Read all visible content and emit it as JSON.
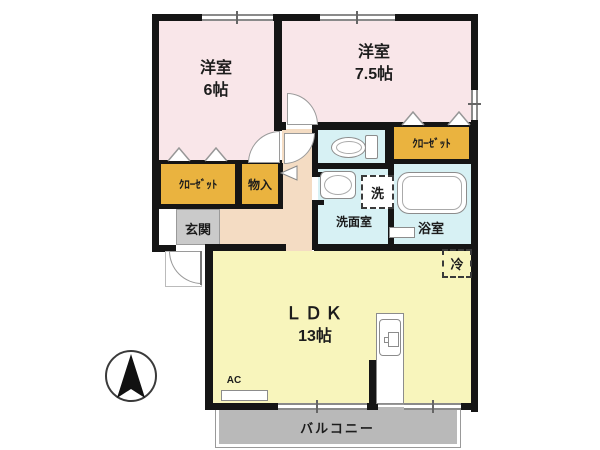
{
  "plan": {
    "rooms": {
      "bedroom6": {
        "name": "洋室",
        "size": "6帖"
      },
      "bedroom75": {
        "name": "洋室",
        "size": "7.5帖"
      },
      "ldk": {
        "name": "ＬＤＫ",
        "size": "13帖"
      },
      "closet_left": {
        "label": "ｸﾛｰｾﾞｯﾄ"
      },
      "closet_right": {
        "label": "ｸﾛｰｾﾞｯﾄ"
      },
      "storage": {
        "label": "物入"
      },
      "entrance": {
        "label": "玄関"
      },
      "washroom": {
        "label": "洗面室"
      },
      "bathroom": {
        "label": "浴室"
      },
      "balcony": {
        "label": "バルコニー"
      }
    },
    "markers": {
      "washer": "洗",
      "fridge": "冷",
      "ac": "AC"
    },
    "colors": {
      "bedroom": "#f9e6e9",
      "ldk": "#f8f5bc",
      "hallway": "#f4dcc3",
      "wet_area": "#d7f1f4",
      "closet": "#eab33f",
      "entrance": "#cacaca",
      "balcony": "#b9b9b9",
      "wall": "#151515"
    }
  }
}
